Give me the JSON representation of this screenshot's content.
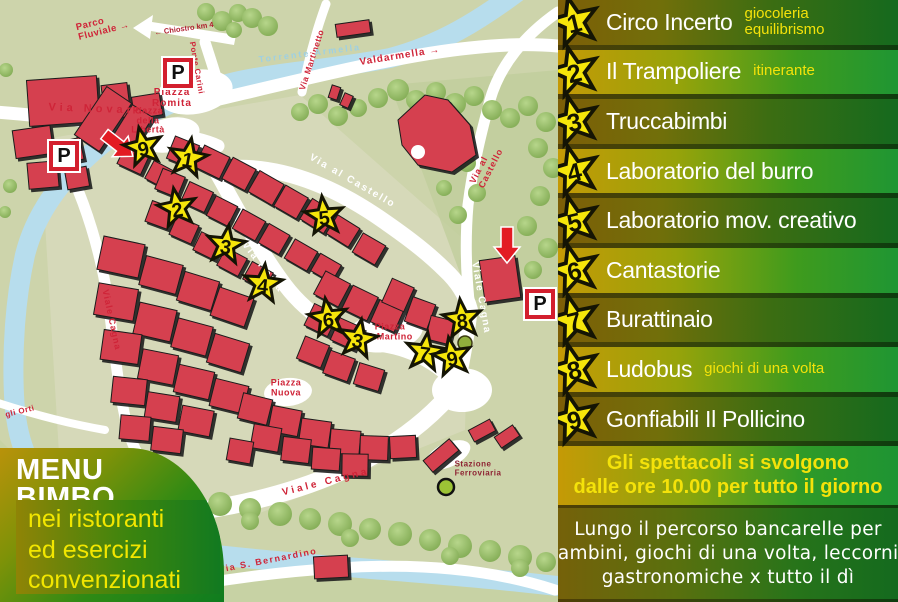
{
  "colors": {
    "map_bg": "#cdd4ab",
    "building_red": "#d5414f",
    "river_blue": "#b7dded",
    "star_yellow": "#f6e60a",
    "panel_gold": "#c59a06",
    "panel_green": "#156a1e",
    "text_yellow": "#f4e20a",
    "label_red": "#cf2438"
  },
  "map": {
    "p_letter": "P",
    "parkings": [
      {
        "x": 178,
        "y": 73
      },
      {
        "x": 64,
        "y": 156
      },
      {
        "x": 540,
        "y": 304
      }
    ],
    "stars": [
      {
        "n": "9",
        "x": 143,
        "y": 147,
        "rot": -12
      },
      {
        "n": "1",
        "x": 188,
        "y": 158,
        "rot": 10
      },
      {
        "n": "2",
        "x": 177,
        "y": 208,
        "rot": -10
      },
      {
        "n": "3",
        "x": 226,
        "y": 245,
        "rot": 8
      },
      {
        "n": "5",
        "x": 324,
        "y": 216,
        "rot": -6
      },
      {
        "n": "4",
        "x": 263,
        "y": 284,
        "rot": 6
      },
      {
        "n": "6",
        "x": 328,
        "y": 318,
        "rot": -8
      },
      {
        "n": "3",
        "x": 358,
        "y": 339,
        "rot": 10
      },
      {
        "n": "8",
        "x": 462,
        "y": 319,
        "rot": -6
      },
      {
        "n": "7",
        "x": 425,
        "y": 352,
        "rot": 8
      },
      {
        "n": "9",
        "x": 452,
        "y": 357,
        "rot": -10
      }
    ],
    "labels": [
      {
        "text": "← Chiostro km 4",
        "x": 184,
        "y": 29,
        "rot": -8,
        "cls": "tinyred",
        "size": 7.5,
        "ls": 0
      },
      {
        "text": "Parco\nFluviale →",
        "x": 103,
        "y": 27,
        "rot": -14,
        "cls": "red",
        "size": 9.5,
        "ls": 0.5
      },
      {
        "text": "Ponte Carini",
        "x": 196,
        "y": 68,
        "rot": 80,
        "cls": "red",
        "size": 8,
        "ls": 0.5
      },
      {
        "text": "Via Martinetto",
        "x": 312,
        "y": 60,
        "rot": -72,
        "cls": "red",
        "size": 8.5,
        "ls": 0.5
      },
      {
        "text": "Torrente Armella",
        "x": 310,
        "y": 54,
        "rot": -7,
        "cls": "blue",
        "size": 9,
        "ls": 2
      },
      {
        "text": "Valdarmella →",
        "x": 400,
        "y": 57,
        "rot": -9,
        "cls": "red",
        "size": 10,
        "ls": 1
      },
      {
        "text": "Via Novaro",
        "x": 97,
        "y": 110,
        "rot": 2,
        "cls": "red",
        "size": 11,
        "ls": 4
      },
      {
        "text": "Piazza\nRomita",
        "x": 172,
        "y": 99,
        "rot": 0,
        "cls": "red",
        "size": 10,
        "ls": 1,
        "align": "center"
      },
      {
        "text": "Piazza\ndella\nLibertà",
        "x": 148,
        "y": 121,
        "rot": 0,
        "cls": "red",
        "size": 9,
        "ls": 0.5,
        "align": "center"
      },
      {
        "text": "Via al Castello",
        "x": 352,
        "y": 182,
        "rot": 30,
        "cls": "white",
        "size": 10,
        "ls": 2
      },
      {
        "text": "Via al Castello",
        "x": 492,
        "y": 156,
        "rot": -63,
        "cls": "red",
        "size": 9,
        "ls": 1
      },
      {
        "text": "Via Roma",
        "x": 262,
        "y": 268,
        "rot": 52,
        "cls": "white",
        "size": 10,
        "ls": 2
      },
      {
        "text": "Viale Cagna",
        "x": 480,
        "y": 298,
        "rot": 80,
        "cls": "white",
        "size": 10,
        "ls": 1.5
      },
      {
        "text": "Viale Cagna",
        "x": 111,
        "y": 320,
        "rot": 78,
        "cls": "red",
        "size": 9,
        "ls": 1
      },
      {
        "text": "Viale Cagna",
        "x": 326,
        "y": 483,
        "rot": -14,
        "cls": "red",
        "size": 10,
        "ls": 3
      },
      {
        "text": "Piazza\nS.Martino",
        "x": 390,
        "y": 332,
        "rot": 0,
        "cls": "red",
        "size": 9,
        "ls": 0.5,
        "align": "center"
      },
      {
        "text": "Piazza\nNuova",
        "x": 286,
        "y": 388,
        "rot": 0,
        "cls": "red",
        "size": 9,
        "ls": 0.5,
        "align": "center"
      },
      {
        "text": "Stazione\nFerroviaria",
        "x": 478,
        "y": 469,
        "rot": 0,
        "cls": "darkred",
        "size": 8,
        "ls": 0.5
      },
      {
        "text": "Via S. Bernardino",
        "x": 268,
        "y": 561,
        "rot": -11,
        "cls": "red",
        "size": 9,
        "ls": 1.5
      },
      {
        "text": "gli Orti",
        "x": 20,
        "y": 412,
        "rot": -14,
        "cls": "red",
        "size": 8,
        "ls": 0.5
      }
    ]
  },
  "menu_bimbo": {
    "title_line1": "MENU",
    "title_line2": "BIMBO",
    "body_lines": [
      "nei ristoranti",
      "ed esercizi",
      "convenzionati"
    ]
  },
  "legend": {
    "rows": [
      {
        "num": "1",
        "title": "Circo Incerto",
        "note": "giocoleria equilibrismo"
      },
      {
        "num": "2",
        "title": "Il Trampoliere",
        "note": "itinerante"
      },
      {
        "num": "3",
        "title": "Truccabimbi",
        "note": ""
      },
      {
        "num": "4",
        "title": "Laboratorio del burro",
        "note": ""
      },
      {
        "num": "5",
        "title": "Laboratorio mov. creativo",
        "note": ""
      },
      {
        "num": "6",
        "title": "Cantastorie",
        "note": ""
      },
      {
        "num": "7",
        "title": "Burattinaio",
        "note": ""
      },
      {
        "num": "8",
        "title": "Ludobus",
        "note": "giochi di una volta"
      },
      {
        "num": "9",
        "title": "Gonfiabili Il Pollicino",
        "note": ""
      }
    ],
    "schedule_lines": [
      "Gli spettacoli si svolgono",
      "dalle ore 10.00 per tutto il giorno"
    ],
    "footer_lines": [
      "Lungo il percorso bancarelle per",
      "bambini, giochi di una volta, leccornie",
      "gastronomiche x tutto il dì"
    ]
  }
}
